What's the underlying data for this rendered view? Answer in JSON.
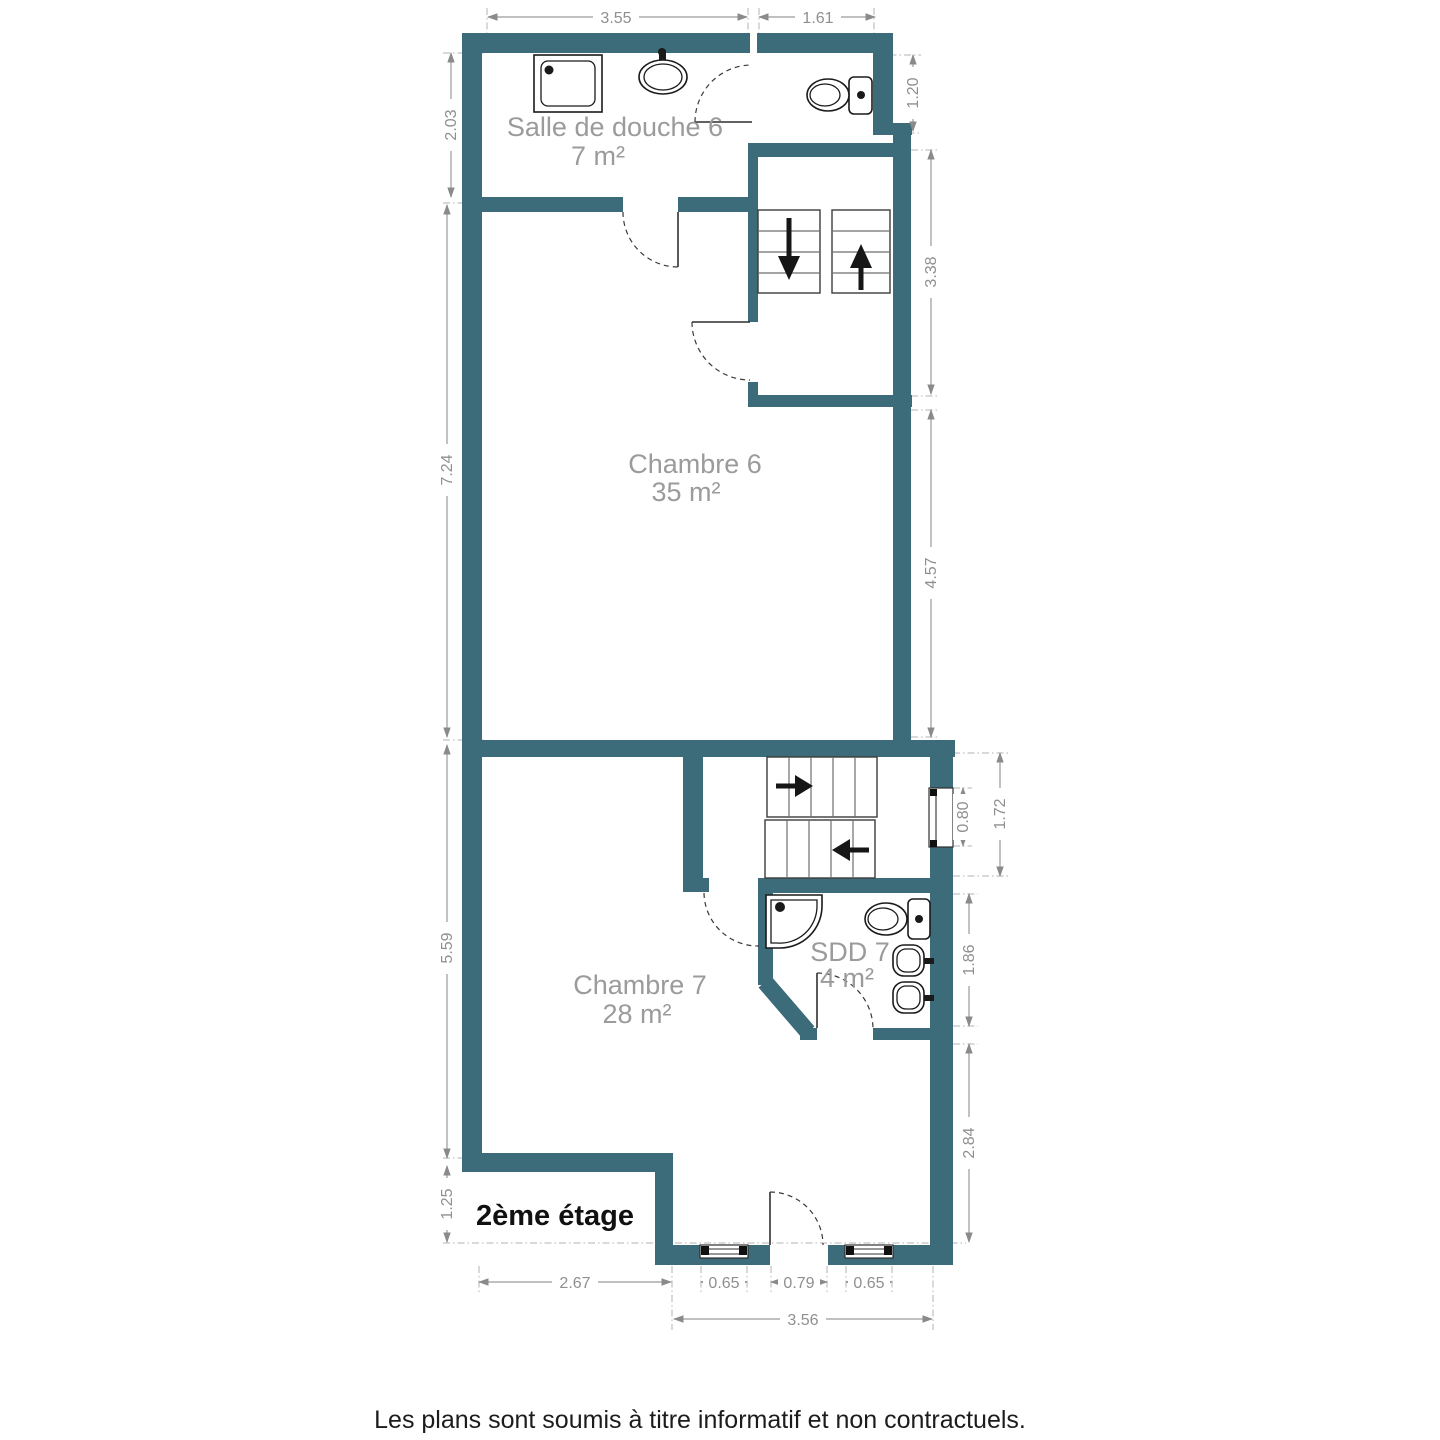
{
  "floor_plan": {
    "floor_label": "2ème étage",
    "disclaimer": "Les plans sont soumis à titre informatif et non contractuels.",
    "colors": {
      "wall": "#3C6B79",
      "dimension": "#8F8F8F",
      "room_label": "#9B9B9B",
      "fixture_outline": "#1A1A1A",
      "text": "#111111"
    },
    "rooms": [
      {
        "name": "Salle de douche 6",
        "area": "7 m²"
      },
      {
        "name": "Chambre 6",
        "area": "35 m²"
      },
      {
        "name": "Chambre 7",
        "area": "28 m²"
      },
      {
        "name": "SDD 7",
        "area": "4 m²"
      }
    ],
    "dimensions": {
      "top": [
        {
          "label": "3.55"
        },
        {
          "label": "1.61"
        }
      ],
      "left": [
        {
          "label": "2.03"
        },
        {
          "label": "7.24"
        },
        {
          "label": "5.59"
        },
        {
          "label": "1.25"
        }
      ],
      "right": [
        {
          "label": "1.20"
        },
        {
          "label": "3.38"
        },
        {
          "label": "4.57"
        },
        {
          "label": "0.80"
        },
        {
          "label": "1.72"
        },
        {
          "label": "1.86"
        },
        {
          "label": "2.84"
        }
      ],
      "bottom": [
        {
          "label": "2.67"
        },
        {
          "label": "0.65"
        },
        {
          "label": "0.79"
        },
        {
          "label": "0.65"
        },
        {
          "label": "3.56"
        }
      ]
    }
  }
}
